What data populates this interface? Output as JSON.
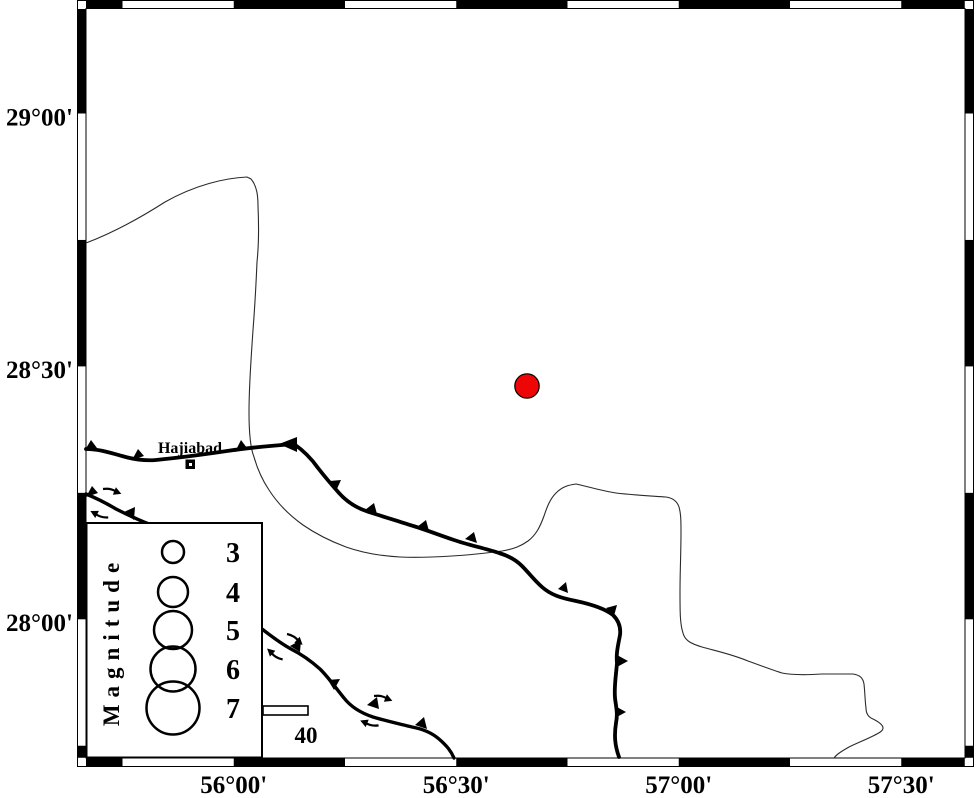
{
  "axes": {
    "y": [
      {
        "label": "29°00'"
      },
      {
        "label": "28°30'"
      },
      {
        "label": "28°00'"
      }
    ],
    "x": [
      {
        "label": "56°00'"
      },
      {
        "label": "56°30'"
      },
      {
        "label": "57°00'"
      },
      {
        "label": "57°30'"
      }
    ]
  },
  "town": {
    "name": "Hajiabad"
  },
  "legend": {
    "title": "Magnitude",
    "entries": [
      {
        "label": "3"
      },
      {
        "label": "4"
      },
      {
        "label": "5"
      },
      {
        "label": "6"
      },
      {
        "label": "7"
      }
    ]
  },
  "scalebar": {
    "label": "40"
  },
  "epicenter": {
    "color": "#ee0505",
    "approx_lon": "56°40'",
    "approx_lat": "28°28'"
  }
}
